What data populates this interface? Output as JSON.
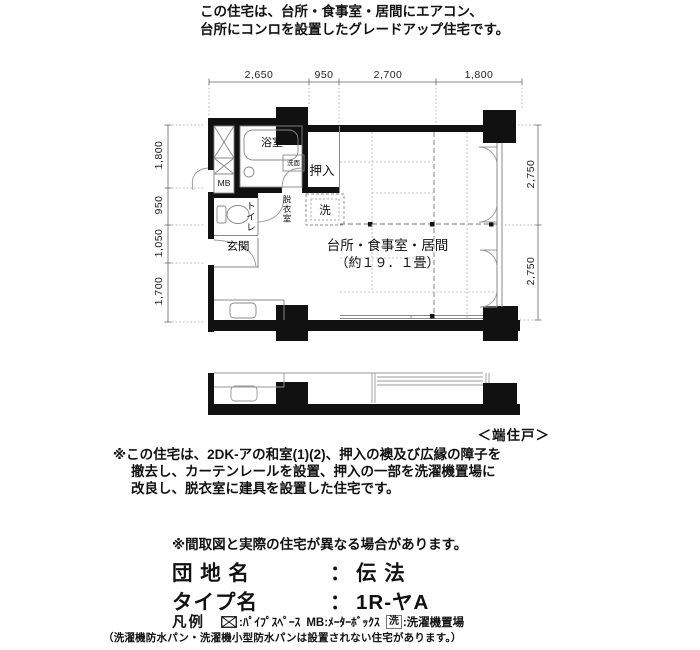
{
  "header": {
    "line1": "この住宅は、台所・食事室・居間にエアコン、",
    "line2": "台所にコンロを設置したグレードアップ住宅です。"
  },
  "plan": {
    "dims": {
      "top": [
        "2,650",
        "950",
        "2,700",
        "1,800"
      ],
      "left": [
        "1,800",
        "950",
        "1,050",
        "1,700"
      ],
      "right": [
        "2,750",
        "2,750"
      ]
    },
    "rooms": {
      "bath": "浴室",
      "washbasin": "洗面",
      "closet": "押入",
      "meter_box": "MB",
      "toilet": "トイレ",
      "dressing": "脱衣室",
      "laundry": "洗",
      "entrance": "玄関",
      "living": "台所・食事室・居間",
      "living_size": "（約１９．１畳）"
    },
    "unit_label": "＜端住戸＞"
  },
  "notes": {
    "remodel_line1": "※この住宅は、2DK-アの和室(1)(2)、押入の襖及び広縁の障子を",
    "remodel_line2": "撤去し、カーテンレールを設置、押入の一部を洗濯機置場に",
    "remodel_line3": "改良し、脱衣室に建具を設置した住宅です。",
    "disclaimer": "※間取図と実際の住宅が異なる場合があります。"
  },
  "info": {
    "estate_label": "団 地 名",
    "estate_sep": "：",
    "estate_value": "伝 法",
    "type_label": "タイプ名",
    "type_sep": "：",
    "type_value": "1R-ヤA"
  },
  "legend": {
    "title": "凡例",
    "pipe_space_label": ":ﾊﾟｲﾌﾟｽﾍﾟｰｽ",
    "mb_label": "MB:ﾒｰﾀｰﾎﾞｯｸｽ",
    "laundry_mark": "洗",
    "laundry_label": ":洗濯機置場",
    "subnote": "（洗濯機防水パン・洗濯機小型防水パンは設置されない住宅があります。）"
  }
}
